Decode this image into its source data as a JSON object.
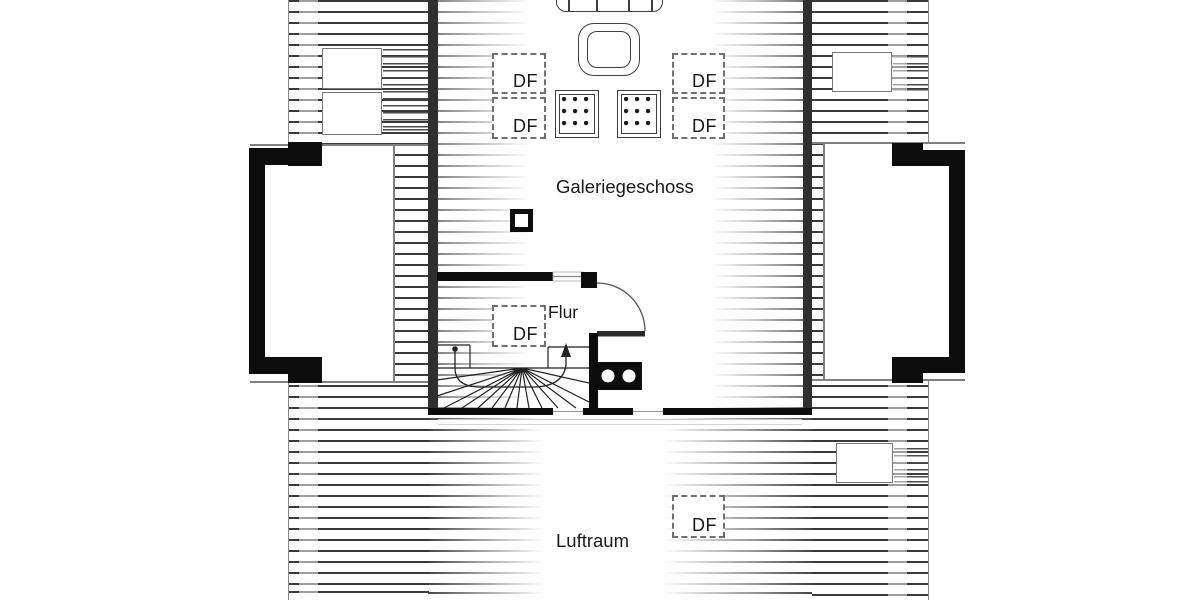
{
  "floor_plan": {
    "labels": {
      "gallery": "Galeriegeschoss",
      "hallway": "Flur",
      "void": "Luftraum"
    },
    "roof_window_labels": [
      "DF",
      "DF",
      "DF",
      "DF",
      "DF",
      "DF"
    ],
    "icons": {
      "furniture": [
        "sofa-icon",
        "coffee-table-icon",
        "stool-icon",
        "stool-icon"
      ],
      "stair": "winder-staircase-icon",
      "door": "door-swing-icon",
      "walkline": "walking-line-arrow-icon"
    },
    "colors": {
      "background": "#ffffff",
      "wall": "#0d0d0d",
      "hatch_line": "#3a3a3a",
      "text": "#1a1a1a",
      "thin_line": "#808080"
    }
  }
}
